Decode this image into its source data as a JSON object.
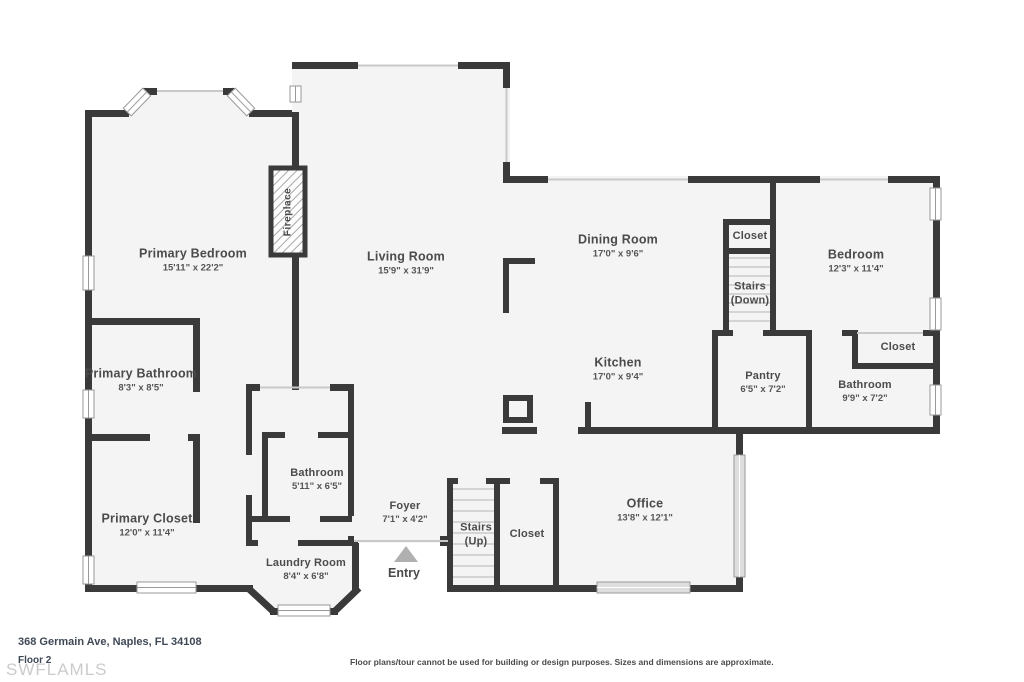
{
  "rooms": [
    {
      "name": "Primary Bedroom",
      "dims": "15'11\" x 22'2\""
    },
    {
      "name": "Living Room",
      "dims": "15'9\" x 31'9\""
    },
    {
      "name": "Dining Room",
      "dims": "17'0\" x 9'6\""
    },
    {
      "name": "Bedroom",
      "dims": "12'3\" x 11'4\""
    },
    {
      "name": "Primary Bathroom",
      "dims": "8'3\" x 8'5\""
    },
    {
      "name": "Kitchen",
      "dims": "17'0\" x 9'4\""
    },
    {
      "name": "Pantry",
      "dims": "6'5\" x 7'2\""
    },
    {
      "name": "Bathroom",
      "dims": "9'9\" x 7'2\""
    },
    {
      "name": "Primary Closet",
      "dims": "12'0\" x 11'4\""
    },
    {
      "name": "Bathroom",
      "dims": "5'11\" x 6'5\""
    },
    {
      "name": "Foyer",
      "dims": "7'1\" x 4'2\""
    },
    {
      "name": "Office",
      "dims": "13'8\" x 12'1\""
    },
    {
      "name": "Laundry Room",
      "dims": "8'4\" x 6'8\""
    },
    {
      "name": "Closet"
    },
    {
      "name": "Stairs",
      "line2": "(Down)"
    },
    {
      "name": "Closet"
    },
    {
      "name": "Stairs",
      "line2": "(Up)"
    },
    {
      "name": "Closet"
    },
    {
      "name": "Entry"
    },
    {
      "name": "Fireplace"
    }
  ],
  "footer": {
    "address": "368 Germain Ave, Naples, FL 34108",
    "floor": "Floor 2",
    "watermark": "SWFLAMLS",
    "disclaimer": "Floor plans/tour cannot be used for building or design purposes. Sizes and dimensions are approximate."
  },
  "colors": {
    "wall": "#3a3a3a",
    "floor": "#f4f4f4",
    "opening": "#c9c9c9",
    "tread": "#c9c9c9",
    "arrow": "#b0b0b0"
  }
}
